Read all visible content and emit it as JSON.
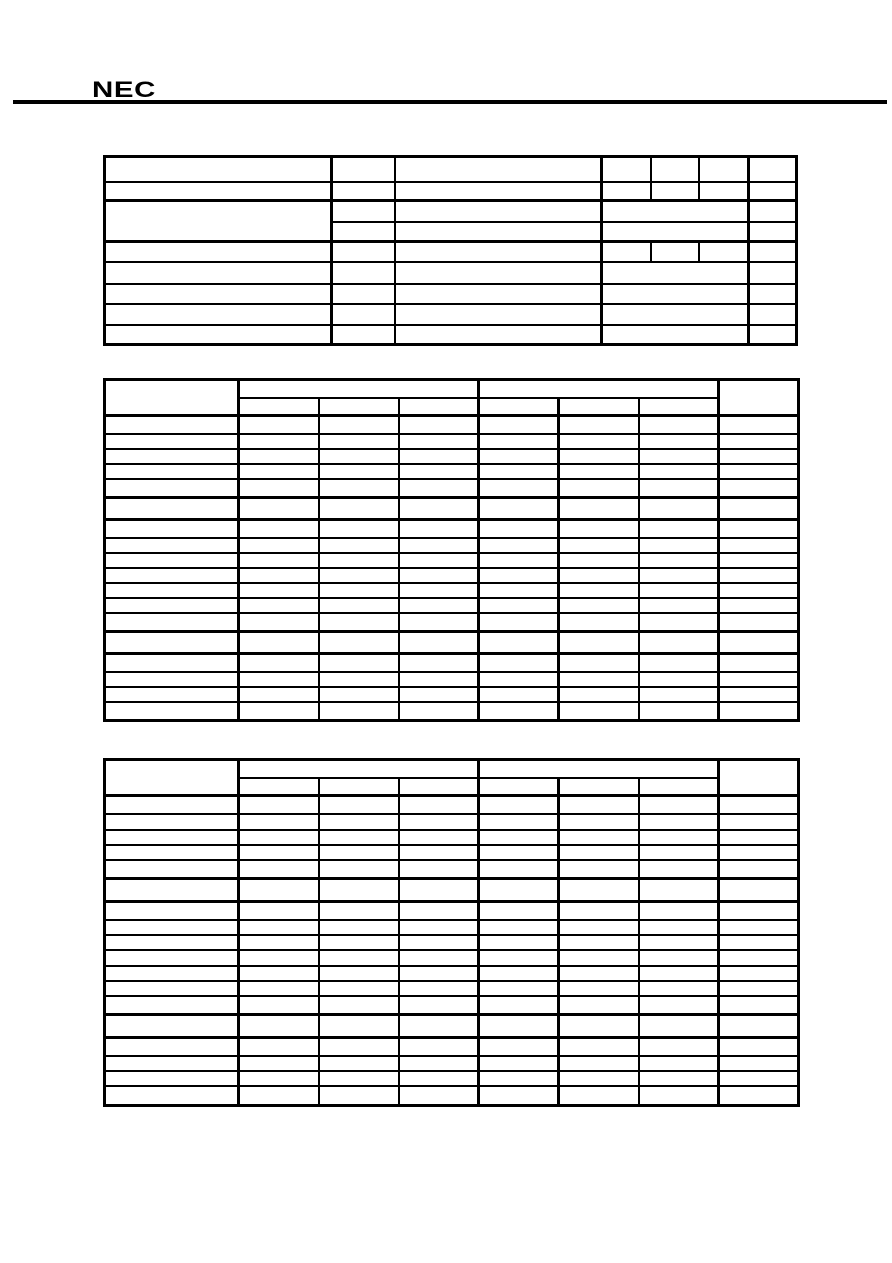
{
  "page": {
    "width": 892,
    "height": 1263,
    "background_color": "#ffffff",
    "line_color": "#000000"
  },
  "header": {
    "logo_text": "NEC"
  },
  "tables": [
    {
      "name": "table-1",
      "columns": 7,
      "rows": 9,
      "cells_empty": true
    },
    {
      "name": "table-2",
      "columns": 8,
      "header_rows": 2,
      "header_group_spans": [
        3,
        3
      ],
      "data_rows": 18,
      "thick_border_rows": [
        6,
        14
      ],
      "cells_empty": true
    },
    {
      "name": "table-3",
      "columns": 8,
      "header_rows": 2,
      "header_group_spans": [
        3,
        3
      ],
      "data_rows": 18,
      "thick_border_rows": [
        6,
        14
      ],
      "cells_empty": true
    }
  ]
}
